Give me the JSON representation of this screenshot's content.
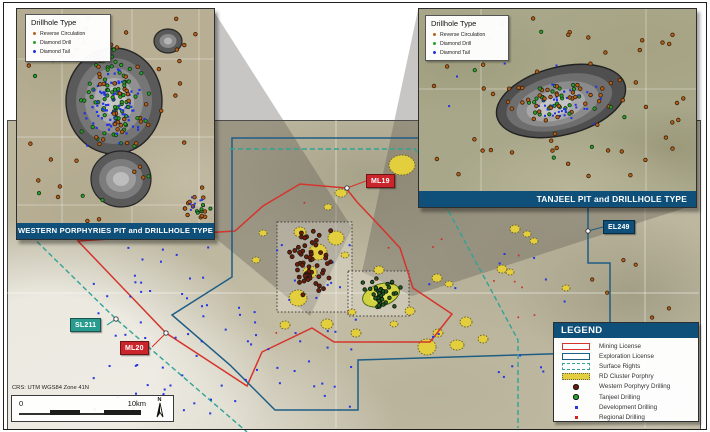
{
  "figure": {
    "crs_text": "CRS: UTM WGS84 Zone 41N"
  },
  "scalebar": {
    "zero_label": "0",
    "max_label": "10km",
    "north_label": "N"
  },
  "drillhole_legend": {
    "title": "Drillhole Type",
    "items": [
      {
        "label": "Reverse Circulation",
        "color": "#b5601d"
      },
      {
        "label": "Diamond Drill",
        "color": "#27a327"
      },
      {
        "label": "Diamond Tail",
        "color": "#2333e0"
      }
    ]
  },
  "insets": {
    "western": {
      "title": "WESTERN PORPHYRIES PIT and DRILLHOLE TYPE"
    },
    "tanjeel": {
      "title": "TANJEEL PIT and DRILLHOLE TYPE"
    }
  },
  "callouts": {
    "ml19": {
      "text": "ML19",
      "color": "#c9252b"
    },
    "ml20": {
      "text": "ML20",
      "color": "#c9252b"
    },
    "sl211": {
      "text": "SL211",
      "color": "#2a9b8f"
    },
    "el249": {
      "text": "EL249",
      "color": "#0e5079"
    }
  },
  "legend": {
    "title": "LEGEND",
    "items": [
      {
        "label": "Mining License"
      },
      {
        "label": "Exploration License"
      },
      {
        "label": "Surface Rights"
      },
      {
        "label": "RD Cluster Porphry"
      },
      {
        "label": "Western Porphyry Drilling"
      },
      {
        "label": "Tanjeel Drilling"
      },
      {
        "label": "Development Drilling"
      },
      {
        "label": "Regional Drilling"
      }
    ]
  },
  "colors": {
    "banner_blue": "#0e5079",
    "mining_license": "#d5342c",
    "exploration_license": "#1e5d84",
    "surface_rights": "#2fa396",
    "rd_cluster_porphyry": "#e3cf3e",
    "western_porphyry_drilling": "#6f1c06",
    "tanjeel_drilling": "#1d5f1d",
    "development_drilling": "#2336e2",
    "regional_drilling": "#d42222",
    "reverse_circulation": "#b5601d",
    "diamond_drill": "#27a327",
    "diamond_tail": "#2333e0"
  },
  "markers": [
    {
      "t": "il",
      "s": 11,
      "n": 70,
      "cx": 97,
      "cy": 92,
      "rx": 38,
      "ry": 50,
      "d": "g",
      "sh": "c",
      "sz": 1.7,
      "f": "#27a327",
      "st": "#143314"
    },
    {
      "t": "il",
      "s": 22,
      "n": 78,
      "cx": 99,
      "cy": 100,
      "rx": 33,
      "ry": 46,
      "d": "g",
      "sh": "s",
      "sz": 2.2,
      "f": "#2333e0",
      "st": "none"
    },
    {
      "t": "il",
      "s": 33,
      "n": 22,
      "cx": 96,
      "cy": 88,
      "rx": 44,
      "ry": 56,
      "d": "g",
      "sh": "c",
      "sz": 1.8,
      "f": "#b5601d",
      "st": "#3a2007"
    },
    {
      "t": "il",
      "s": 44,
      "n": 42,
      "cx": 98,
      "cy": 110,
      "rx": 92,
      "ry": 102,
      "d": "u",
      "sh": "c",
      "sz": 1.8,
      "f": "#b5601d",
      "st": "#3a2007"
    },
    {
      "t": "il",
      "s": 55,
      "n": 12,
      "cx": 95,
      "cy": 120,
      "rx": 88,
      "ry": 95,
      "d": "u",
      "sh": "c",
      "sz": 1.7,
      "f": "#27a327",
      "st": "#143314"
    },
    {
      "t": "il",
      "s": 66,
      "n": 10,
      "cx": 180,
      "cy": 200,
      "rx": 14,
      "ry": 12,
      "d": "g",
      "sh": "c",
      "sz": 1.8,
      "f": "#b5601d",
      "st": "#3a2007"
    },
    {
      "t": "il",
      "s": 77,
      "n": 9,
      "cx": 183,
      "cy": 196,
      "rx": 12,
      "ry": 10,
      "d": "g",
      "sh": "s",
      "sz": 2,
      "f": "#2333e0",
      "st": "none"
    },
    {
      "t": "il",
      "s": 78,
      "n": 6,
      "cx": 182,
      "cy": 202,
      "rx": 12,
      "ry": 10,
      "d": "g",
      "sh": "c",
      "sz": 1.6,
      "f": "#27a327",
      "st": "#143314"
    },
    {
      "t": "ir",
      "s": 88,
      "n": 26,
      "cx": 137,
      "cy": 92,
      "rx": 44,
      "ry": 20,
      "d": "g",
      "sh": "c",
      "sz": 1.7,
      "f": "#27a327",
      "st": "#143314"
    },
    {
      "t": "ir",
      "s": 99,
      "n": 36,
      "cx": 142,
      "cy": 95,
      "rx": 48,
      "ry": 22,
      "d": "g",
      "sh": "s",
      "sz": 2,
      "f": "#2333e0",
      "st": "none"
    },
    {
      "t": "ir",
      "s": 111,
      "n": 28,
      "cx": 142,
      "cy": 90,
      "rx": 52,
      "ry": 25,
      "d": "g",
      "sh": "c",
      "sz": 1.8,
      "f": "#b5601d",
      "st": "#3a2007"
    },
    {
      "t": "ir",
      "s": 122,
      "n": 58,
      "cx": 138,
      "cy": 88,
      "rx": 128,
      "ry": 80,
      "d": "u",
      "sh": "c",
      "sz": 1.8,
      "f": "#b5601d",
      "st": "#3a2007"
    },
    {
      "t": "ir",
      "s": 133,
      "n": 8,
      "cx": 120,
      "cy": 90,
      "rx": 100,
      "ry": 70,
      "d": "u",
      "sh": "c",
      "sz": 1.7,
      "f": "#27a327",
      "st": "#143314"
    },
    {
      "t": "ir",
      "s": 144,
      "n": 6,
      "cx": 100,
      "cy": 95,
      "rx": 80,
      "ry": 60,
      "d": "u",
      "sh": "s",
      "sz": 2,
      "f": "#2333e0",
      "st": "none"
    },
    {
      "t": "ov",
      "s": 155,
      "n": 88,
      "cx": 225,
      "cy": 330,
      "rx": 133,
      "ry": 86,
      "d": "u",
      "sh": "s",
      "sz": 2,
      "f": "#2336e2",
      "st": "none"
    },
    {
      "t": "ov",
      "s": 166,
      "n": 16,
      "cx": 500,
      "cy": 318,
      "rx": 72,
      "ry": 66,
      "d": "u",
      "sh": "s",
      "sz": 2,
      "f": "#2336e2",
      "st": "none"
    },
    {
      "t": "ov",
      "s": 177,
      "n": 58,
      "cx": 312,
      "cy": 264,
      "rx": 24,
      "ry": 38,
      "d": "g",
      "sh": "c",
      "sz": 2,
      "f": "#6f1c06",
      "st": "#191919"
    },
    {
      "t": "ov",
      "s": 188,
      "n": 40,
      "cx": 381,
      "cy": 294,
      "rx": 22,
      "ry": 18,
      "d": "g",
      "sh": "c",
      "sz": 1.8,
      "f": "#1d5f1d",
      "st": "#101010"
    },
    {
      "t": "ov",
      "s": 199,
      "n": 12,
      "cx": 400,
      "cy": 285,
      "rx": 145,
      "ry": 85,
      "d": "u",
      "sh": "s",
      "sz": 1.6,
      "f": "#d42222",
      "st": "none"
    },
    {
      "t": "ov",
      "s": 211,
      "n": 6,
      "cx": 625,
      "cy": 295,
      "rx": 55,
      "ry": 55,
      "d": "u",
      "sh": "c",
      "sz": 1.7,
      "f": "#b5601d",
      "st": "#3a2007"
    }
  ]
}
